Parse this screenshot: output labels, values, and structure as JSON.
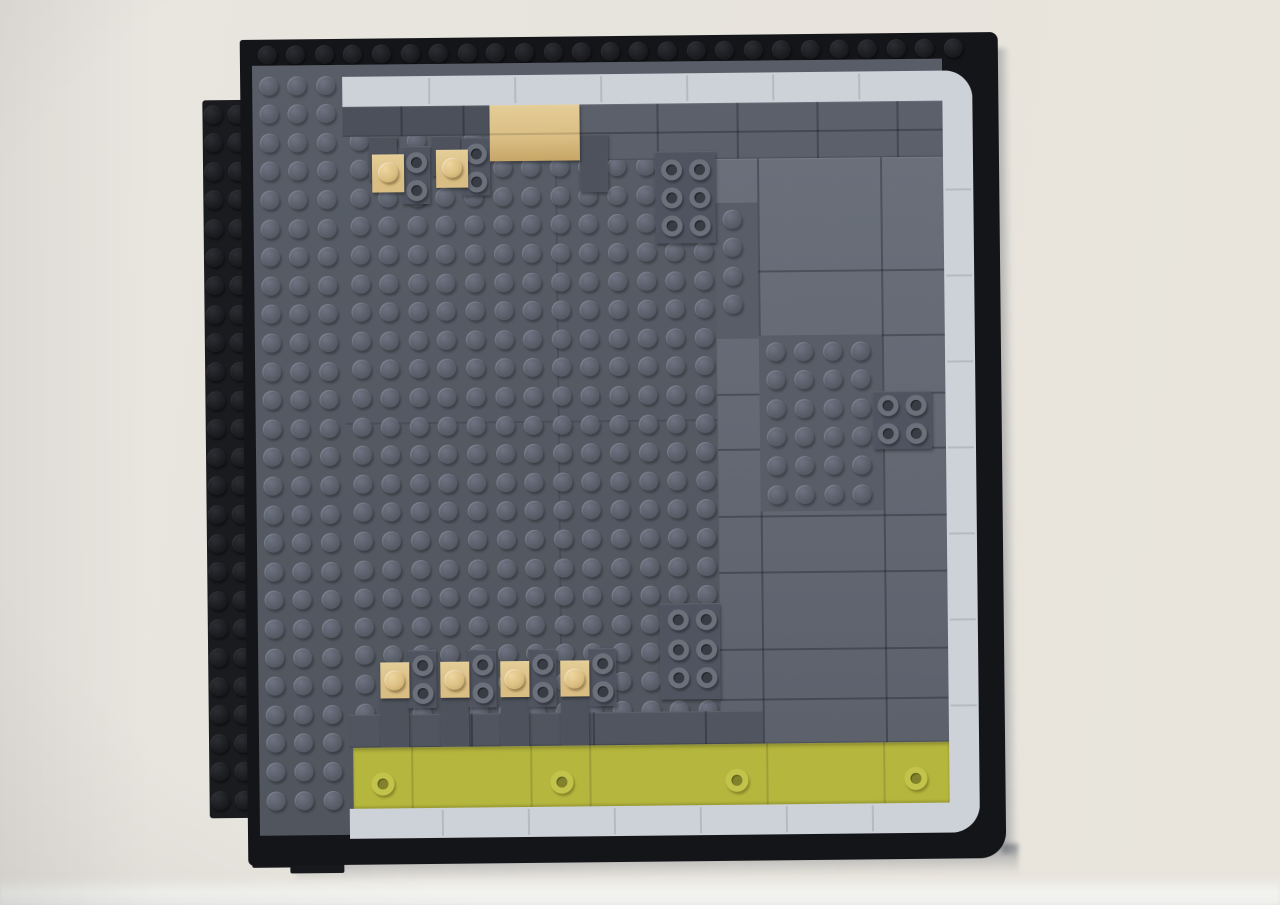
{
  "scene": {
    "subject": "LEGO brick mosaic panel mounted on a wall",
    "width": 1280,
    "height": 905,
    "rotation_deg": -0.6
  },
  "palette": {
    "wall_left": "#e9e6e0",
    "wall_mid": "#e7e4dd",
    "wall_right": "#e9e5dc",
    "baseboard": "#f3f3f0",
    "frame_black": "#141519",
    "tab_black": "#1a1b1e",
    "step_black": "#17181c",
    "base_gray_top": "#585d67",
    "base_gray_bottom": "#50555e",
    "band_dark": "#4b505a",
    "band_mid": "#5b606b",
    "tile_light_top": "#6a6f7a",
    "tile_light_bottom": "#5c616c",
    "pre_olive_band": "#50555f",
    "tab_gray": "#4d525c",
    "cluster_plate": "#505460",
    "white_tile": "#cdd1d8",
    "tan": "#d9bd82",
    "tan_light": "#e4cd97",
    "olive": "#b5b63d",
    "shadow": "rgba(75,82,94,0.55)"
  },
  "wall": {
    "baseboard_y": 876,
    "baseboard_h": 29
  },
  "shadows": {
    "bottom": {
      "x": 292,
      "y": 848,
      "w": 722,
      "h": 30
    },
    "right": {
      "x": 998,
      "y": 52,
      "w": 16,
      "h": 806
    }
  },
  "left_tab": {
    "x": 206,
    "y": 96,
    "w": 48,
    "h": 718,
    "stud_cols": [
      216,
      240
    ],
    "stud_row_y0": 110,
    "stud_rows": 25,
    "pitch": 28.6
  },
  "bottom_steps": [
    {
      "x": 248,
      "y": 848,
      "w": 46,
      "h": 16
    },
    {
      "x": 286,
      "y": 854,
      "w": 54,
      "h": 16
    }
  ],
  "frame": {
    "x": 244,
    "y": 36,
    "w": 758,
    "h": 826,
    "radius": "3px 8px 26px 6px",
    "stud_row": {
      "y": 51,
      "x0": 271,
      "count": 25,
      "pitch": 28.6
    }
  },
  "base": {
    "x": 256,
    "y": 62,
    "w": 690,
    "h": 770,
    "seams_v": [
      {
        "x": 558,
        "y": 122,
        "len": 620
      }
    ],
    "seams_h": [
      {
        "x": 346,
        "y": 420,
        "len": 412
      }
    ]
  },
  "stud_pitch": 28.6,
  "stud_regions": [
    {
      "name": "left-column",
      "cx0": 272,
      "cy0": 82,
      "cols": 3,
      "rows": 26
    },
    {
      "name": "main-field",
      "cx0": 362,
      "cy0": 138,
      "cols": 14,
      "rows": 21
    },
    {
      "name": "patch-a",
      "cx0": 734,
      "cy0": 220,
      "cols": 1,
      "rows": 4
    },
    {
      "name": "patch-b",
      "cx0": 776,
      "cy0": 353,
      "cols": 4,
      "rows": 6
    }
  ],
  "smooth_tiles": [
    {
      "name": "top-band-left",
      "x": 346,
      "y": 104,
      "w": 237,
      "h": 30,
      "color": "band_dark",
      "vseams": [
        58,
        120,
        178
      ],
      "hseams": []
    },
    {
      "name": "top-band-right",
      "x": 583,
      "y": 104,
      "w": 363,
      "h": 56,
      "color": "band_mid",
      "vseams": [
        77,
        157,
        237,
        317
      ],
      "hseams": [
        28
      ]
    },
    {
      "name": "right-tile-region",
      "x": 718,
      "y": 160,
      "w": 228,
      "h": 585,
      "grad": true,
      "vseams": [
        42,
        165
      ],
      "hseams": [
        112,
        177,
        235,
        290,
        357,
        413,
        490,
        540
      ]
    },
    {
      "name": "pre-olive-band",
      "x": 346,
      "y": 712,
      "w": 414,
      "h": 33,
      "color": "pre_olive_band",
      "vseams": [
        122,
        244,
        356
      ],
      "hseams": []
    }
  ],
  "stud_patches_bg": [
    {
      "x": 718,
      "y": 204,
      "w": 42,
      "h": 136
    },
    {
      "x": 760,
      "y": 337,
      "w": 123,
      "h": 176
    }
  ],
  "tabs": [
    {
      "x": 372,
      "y": 134,
      "w": 28,
      "h": 44
    },
    {
      "x": 435,
      "y": 134,
      "w": 28,
      "h": 40
    },
    {
      "x": 583,
      "y": 134,
      "w": 28,
      "h": 58
    },
    {
      "x": 378,
      "y": 694,
      "w": 28,
      "h": 52
    },
    {
      "x": 438,
      "y": 694,
      "w": 28,
      "h": 52
    },
    {
      "x": 498,
      "y": 694,
      "w": 28,
      "h": 52
    },
    {
      "x": 558,
      "y": 694,
      "w": 28,
      "h": 52
    }
  ],
  "hollow_clusters": [
    {
      "plate": {
        "x": 658,
        "y": 152,
        "w": 60,
        "h": 92
      },
      "studs": [
        [
          674,
          170
        ],
        [
          702,
          170
        ],
        [
          674,
          198
        ],
        [
          702,
          198
        ],
        [
          674,
          226
        ],
        [
          702,
          226
        ]
      ]
    },
    {
      "plate": {
        "x": 874,
        "y": 394,
        "w": 58,
        "h": 58
      },
      "studs": [
        [
          888,
          408
        ],
        [
          916,
          408
        ],
        [
          888,
          436
        ],
        [
          916,
          436
        ]
      ]
    },
    {
      "plate": {
        "x": 658,
        "y": 604,
        "w": 60,
        "h": 96
      },
      "studs": [
        [
          676,
          620
        ],
        [
          704,
          620
        ],
        [
          676,
          650
        ],
        [
          704,
          650
        ],
        [
          676,
          678
        ],
        [
          704,
          678
        ]
      ]
    },
    {
      "plate": {
        "x": 405,
        "y": 144,
        "w": 28,
        "h": 58
      },
      "studs": [
        [
          419,
          160
        ],
        [
          419,
          188
        ]
      ]
    },
    {
      "plate": {
        "x": 465,
        "y": 136,
        "w": 28,
        "h": 58
      },
      "studs": [
        [
          479,
          152
        ],
        [
          479,
          180
        ]
      ]
    },
    {
      "plate": {
        "x": 406,
        "y": 648,
        "w": 28,
        "h": 58
      },
      "studs": [
        [
          420,
          663
        ],
        [
          420,
          691
        ]
      ]
    },
    {
      "plate": {
        "x": 466,
        "y": 648,
        "w": 28,
        "h": 58
      },
      "studs": [
        [
          480,
          663
        ],
        [
          480,
          691
        ]
      ]
    },
    {
      "plate": {
        "x": 526,
        "y": 648,
        "w": 28,
        "h": 58
      },
      "studs": [
        [
          540,
          663
        ],
        [
          540,
          691
        ]
      ]
    },
    {
      "plate": {
        "x": 586,
        "y": 648,
        "w": 28,
        "h": 58
      },
      "studs": [
        [
          600,
          663
        ],
        [
          600,
          691
        ]
      ]
    }
  ],
  "tan_block": {
    "x": 493,
    "y": 104,
    "w": 90,
    "h": 56,
    "hseam": 28
  },
  "tan_plates": [
    {
      "x": 375,
      "y": 152,
      "w": 32,
      "h": 38,
      "stud": [
        391,
        170
      ]
    },
    {
      "x": 439,
      "y": 148,
      "w": 32,
      "h": 38,
      "stud": [
        455,
        166
      ]
    },
    {
      "x": 378,
      "y": 660,
      "w": 29,
      "h": 36,
      "stud": [
        392,
        678
      ]
    },
    {
      "x": 438,
      "y": 660,
      "w": 29,
      "h": 36,
      "stud": [
        452,
        678
      ]
    },
    {
      "x": 498,
      "y": 660,
      "w": 29,
      "h": 36,
      "stud": [
        512,
        678
      ]
    },
    {
      "x": 558,
      "y": 660,
      "w": 29,
      "h": 36,
      "stud": [
        572,
        678
      ]
    }
  ],
  "olive_strip": {
    "x": 350,
    "y": 745,
    "w": 596,
    "h": 61,
    "vseams": [
      58,
      177,
      236,
      413,
      530
    ],
    "studs": [
      [
        379,
        781
      ],
      [
        558,
        781
      ],
      [
        733,
        781
      ],
      [
        912,
        781
      ]
    ]
  },
  "white_border": {
    "x": 346,
    "y": 74,
    "w": 630,
    "h": 762,
    "thickness": 30,
    "radius": 28,
    "top_seams_x": [
      432,
      518,
      604,
      690,
      776,
      862
    ],
    "right_seams_y": [
      192,
      278,
      364,
      450,
      536,
      622,
      708
    ],
    "bottom_seams_x": [
      438,
      524,
      610,
      696,
      782,
      868
    ]
  }
}
